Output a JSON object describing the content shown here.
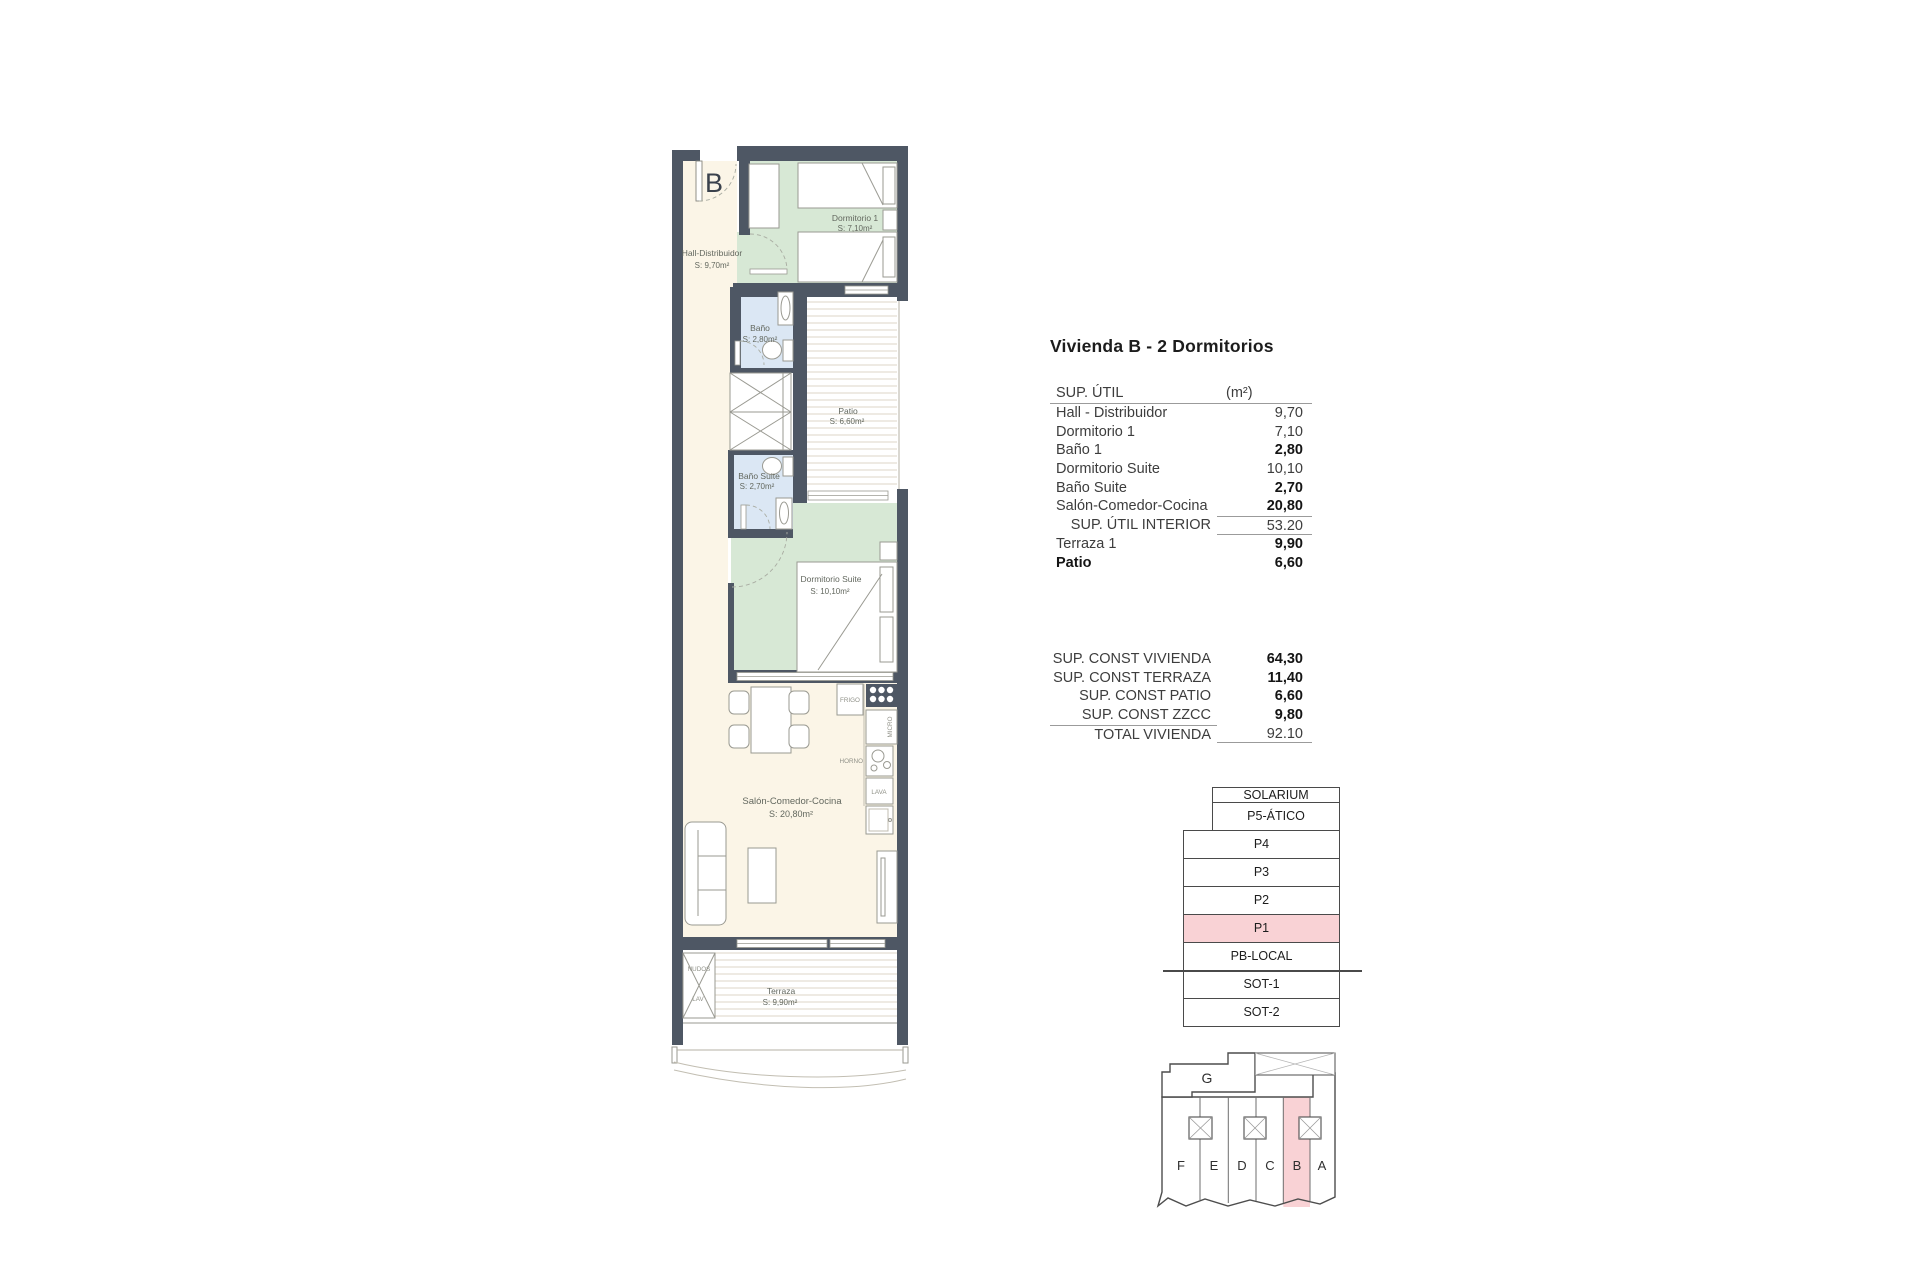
{
  "colors": {
    "wall": "#4e5764",
    "room_cream": "#fbf5e7",
    "room_green": "#d7e8d5",
    "room_blue": "#dbe7f4",
    "stripe": "#ddd6c7",
    "highlight_pink": "#f9d2d5"
  },
  "plan": {
    "unit_letter": "B",
    "rooms": {
      "hall": {
        "label": "Hall-Distribuidor",
        "area": "S: 9,70m²"
      },
      "dormitorio1": {
        "label": "Dormitorio 1",
        "area": "S: 7,10m²"
      },
      "bano": {
        "label": "Baño",
        "area": "S: 2,80m²"
      },
      "patio": {
        "label": "Patio",
        "area": "S: 6,60m²"
      },
      "bano_suite": {
        "label": "Baño Suite",
        "area": "S: 2,70m²"
      },
      "dormitorio_suite": {
        "label": "Dormitorio Suite",
        "area": "S: 10,10m²"
      },
      "salon": {
        "label": "Salón-Comedor-Cocina",
        "area": "S: 20,80m²"
      },
      "terraza": {
        "label": "Terraza",
        "area": "S: 9,90m²"
      }
    },
    "appliances": {
      "frigo": "FRIGO",
      "micro": "MICRO",
      "horno": "HORNO",
      "lava": "LAVA"
    },
    "laundry": {
      "nudos": "NUDOS",
      "lav": "LAV"
    }
  },
  "table": {
    "title": "Vivienda B - 2 Dormitorios",
    "header": {
      "label": "SUP. ÚTIL",
      "unit": "(m²)"
    },
    "rows": [
      {
        "label": "Hall - Distribuidor",
        "value": "9,70"
      },
      {
        "label": "Dormitorio 1",
        "value": "7,10"
      },
      {
        "label": "Baño 1",
        "value": "2,80"
      },
      {
        "label": "Dormitorio Suite",
        "value": "10,10"
      },
      {
        "label": "Baño Suite",
        "value": "2,70"
      },
      {
        "label": "Salón-Comedor-Cocina",
        "value": "20,80"
      }
    ],
    "subtotal": {
      "label": "SUP. ÚTIL INTERIOR",
      "value": "53.20"
    },
    "outdoor_rows": [
      {
        "label": "Terraza 1",
        "value": "9,90"
      },
      {
        "label": "Patio",
        "value": "6,60"
      }
    ],
    "const_rows": [
      {
        "label": "SUP. CONST VIVIENDA",
        "value": "64,30"
      },
      {
        "label": "SUP. CONST TERRAZA",
        "value": "11,40"
      },
      {
        "label": "SUP. CONST PATIO",
        "value": "6,60"
      },
      {
        "label": "SUP. CONST ZZCC",
        "value": "9,80"
      }
    ],
    "total": {
      "label": "TOTAL VIVIENDA",
      "value": "92.10"
    }
  },
  "stack": {
    "floors": [
      "SOLARIUM",
      "P5-ÁTICO",
      "P4",
      "P3",
      "P2",
      "P1",
      "PB-LOCAL",
      "SOT-1",
      "SOT-2"
    ],
    "highlighted": "P1"
  },
  "keyplan": {
    "g_label": "G",
    "units": [
      "F",
      "E",
      "D",
      "C",
      "B",
      "A"
    ],
    "highlighted": "B"
  }
}
